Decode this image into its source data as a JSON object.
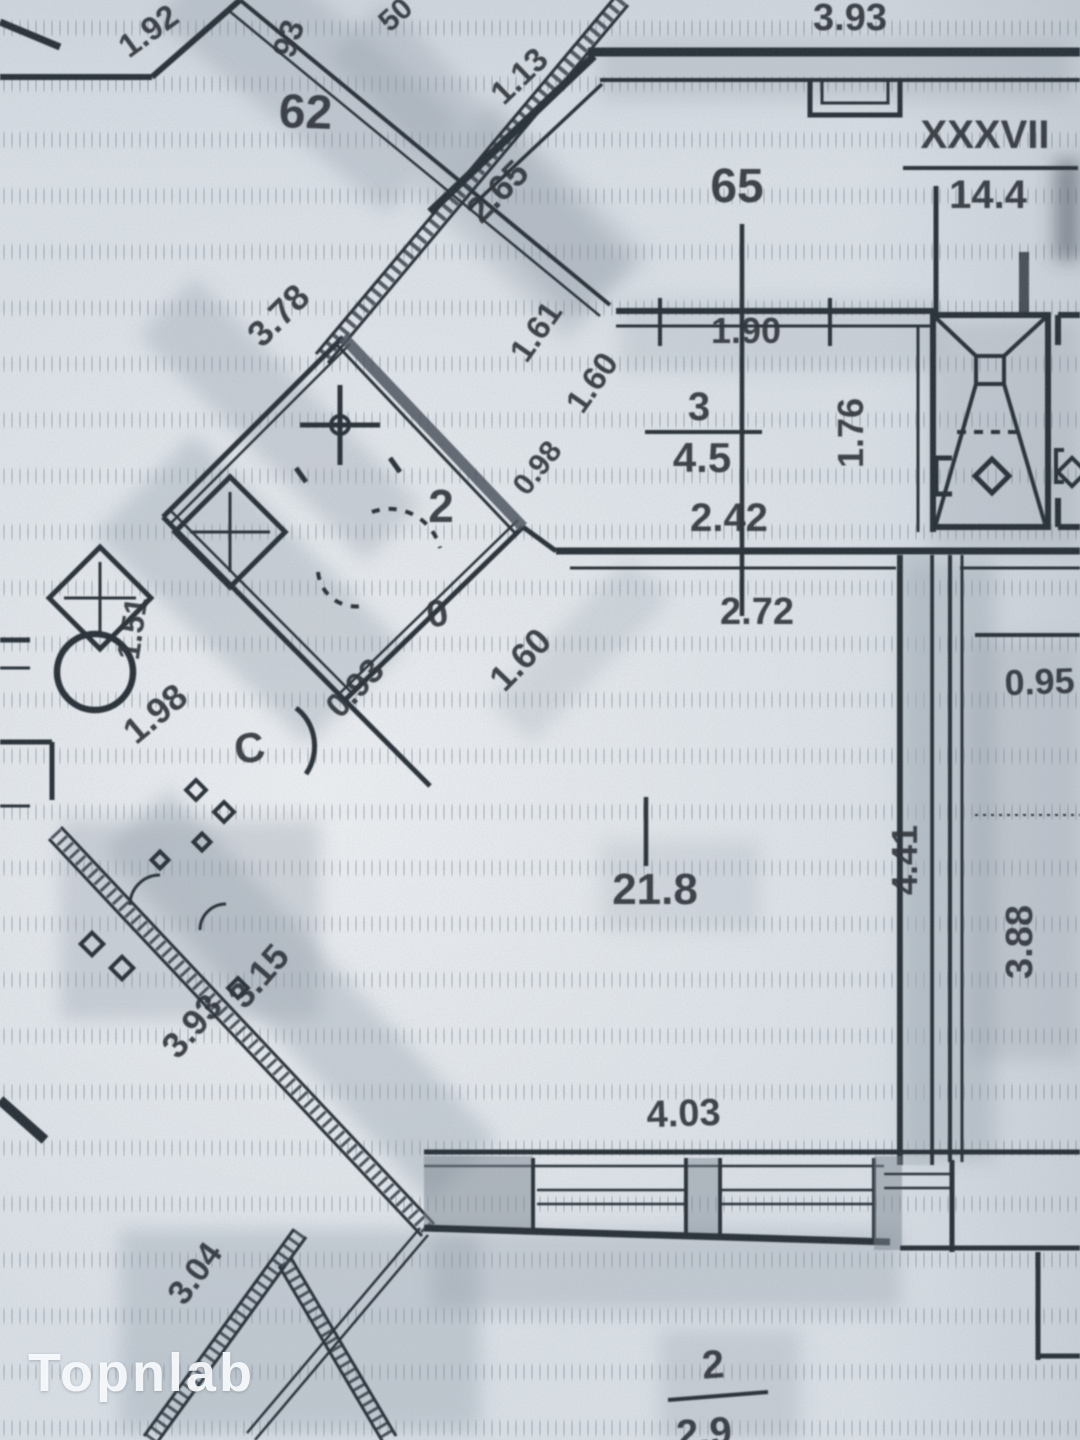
{
  "palette": {
    "paper": "#dce2e8",
    "ink": "#2c3239",
    "shade": "#8a95a1",
    "watermark": "#fafcfe"
  },
  "watermark": {
    "label": "Topnlab"
  },
  "apartments": {
    "neighbor_number": "62",
    "unit_number": "65"
  },
  "stairwell": {
    "roman_label": "XXXVII",
    "area": "14.4"
  },
  "rooms": {
    "room2": {
      "number": "2"
    },
    "room3": {
      "number": "3",
      "area": "4.5"
    },
    "living": {
      "area": "21.8"
    },
    "balcony": {
      "number": "2",
      "area": "2.9"
    }
  },
  "symbols": {
    "letter_c": "С",
    "zero_mark": "0"
  },
  "dimensions": {
    "d192": "1.92",
    "d93": "93",
    "d50": "50",
    "d113": "1.13",
    "d265": "2.65",
    "top393": "3.93",
    "d378": "3.78",
    "d161": "1.61",
    "d190": "1.90",
    "d176": "1.76",
    "d242": "2.42",
    "d160_upper": "1.60",
    "d098": "0.98",
    "d272": "2.72",
    "d095": "0.95",
    "d388": "3.88",
    "d441": "4.41",
    "d151": "1.51",
    "d198": "1.98",
    "d093": "0.93",
    "d160_lower": "1.60",
    "d315": "3.15",
    "d393_diag": "3.93",
    "d403": "4.03",
    "d304": "3.04"
  }
}
